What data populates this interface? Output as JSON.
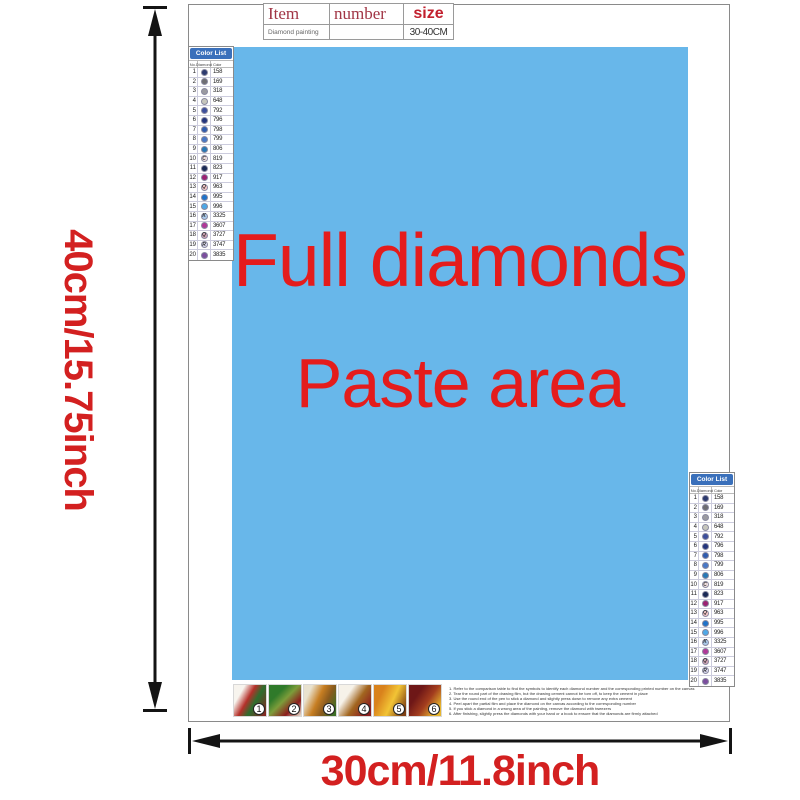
{
  "info_table": {
    "headers": [
      "Item",
      "number",
      "size"
    ],
    "row": {
      "item": "Diamond painting",
      "number": "",
      "size": "30-40CM"
    }
  },
  "paste_area": {
    "line1": "Full diamonds",
    "line2": "Paste area",
    "bg_color": "#68b7ea",
    "text_color": "#e41c1c"
  },
  "dimensions": {
    "height_label": "40cm/15.75inch",
    "width_label": "30cm/11.8inch",
    "label_color": "#d32020"
  },
  "color_list": {
    "title": "Color List",
    "columns": [
      "No.",
      "Diamond",
      "Color"
    ],
    "header_bg": "#3a70bb",
    "rows": [
      {
        "no": "1",
        "code": "158",
        "dot": "#2c3a6e",
        "letter": ""
      },
      {
        "no": "2",
        "code": "169",
        "dot": "#6e6e72",
        "letter": ""
      },
      {
        "no": "3",
        "code": "318",
        "dot": "#9a9aa0",
        "letter": ""
      },
      {
        "no": "4",
        "code": "648",
        "dot": "#c6c6bc",
        "letter": ""
      },
      {
        "no": "5",
        "code": "792",
        "dot": "#3d4f9c",
        "letter": ""
      },
      {
        "no": "6",
        "code": "796",
        "dot": "#23357d",
        "letter": ""
      },
      {
        "no": "7",
        "code": "798",
        "dot": "#2f5cae",
        "letter": ""
      },
      {
        "no": "8",
        "code": "799",
        "dot": "#4878c6",
        "letter": ""
      },
      {
        "no": "9",
        "code": "806",
        "dot": "#2878b4",
        "letter": ""
      },
      {
        "no": "10",
        "code": "819",
        "dot": "#f7e6e6",
        "letter": "C"
      },
      {
        "no": "11",
        "code": "823",
        "dot": "#1a2a55",
        "letter": ""
      },
      {
        "no": "12",
        "code": "917",
        "dot": "#9c2272",
        "letter": ""
      },
      {
        "no": "13",
        "code": "963",
        "dot": "#f5c6c6",
        "letter": "Q"
      },
      {
        "no": "14",
        "code": "995",
        "dot": "#1f72c8",
        "letter": ""
      },
      {
        "no": "15",
        "code": "996",
        "dot": "#4fa8e6",
        "letter": ""
      },
      {
        "no": "16",
        "code": "3325",
        "dot": "#a9c9ea",
        "letter": "K"
      },
      {
        "no": "17",
        "code": "3607",
        "dot": "#b03898",
        "letter": ""
      },
      {
        "no": "18",
        "code": "3727",
        "dot": "#cfa2b4",
        "letter": "Q"
      },
      {
        "no": "19",
        "code": "3747",
        "dot": "#dcdcf2",
        "letter": "R"
      },
      {
        "no": "20",
        "code": "3835",
        "dot": "#7c4e9e",
        "letter": ""
      }
    ]
  },
  "step_numbers": [
    "1",
    "2",
    "3",
    "4",
    "5",
    "6"
  ],
  "instructions": {
    "lines": [
      "1. Refer to the comparison table to find the symbols to identify each diamond number and the corresponding printed number on the canvas",
      "2. Tear the round part of the drawing film, but the drawing cement cannot be torn off, to keep the cement in place",
      "3. Use the round end of the pen to stick a diamond and slightly press down to remove any extra cement",
      "4. Peel apart the partial film and place the diamond on the canvas according to the corresponding number",
      "5. If you stick a diamond in a wrong area of the painting, remove the diamond with tweezers",
      "6. After finishing, slightly press the diamonds with your hand or a book to ensure that the diamonds are firmly attached"
    ]
  }
}
